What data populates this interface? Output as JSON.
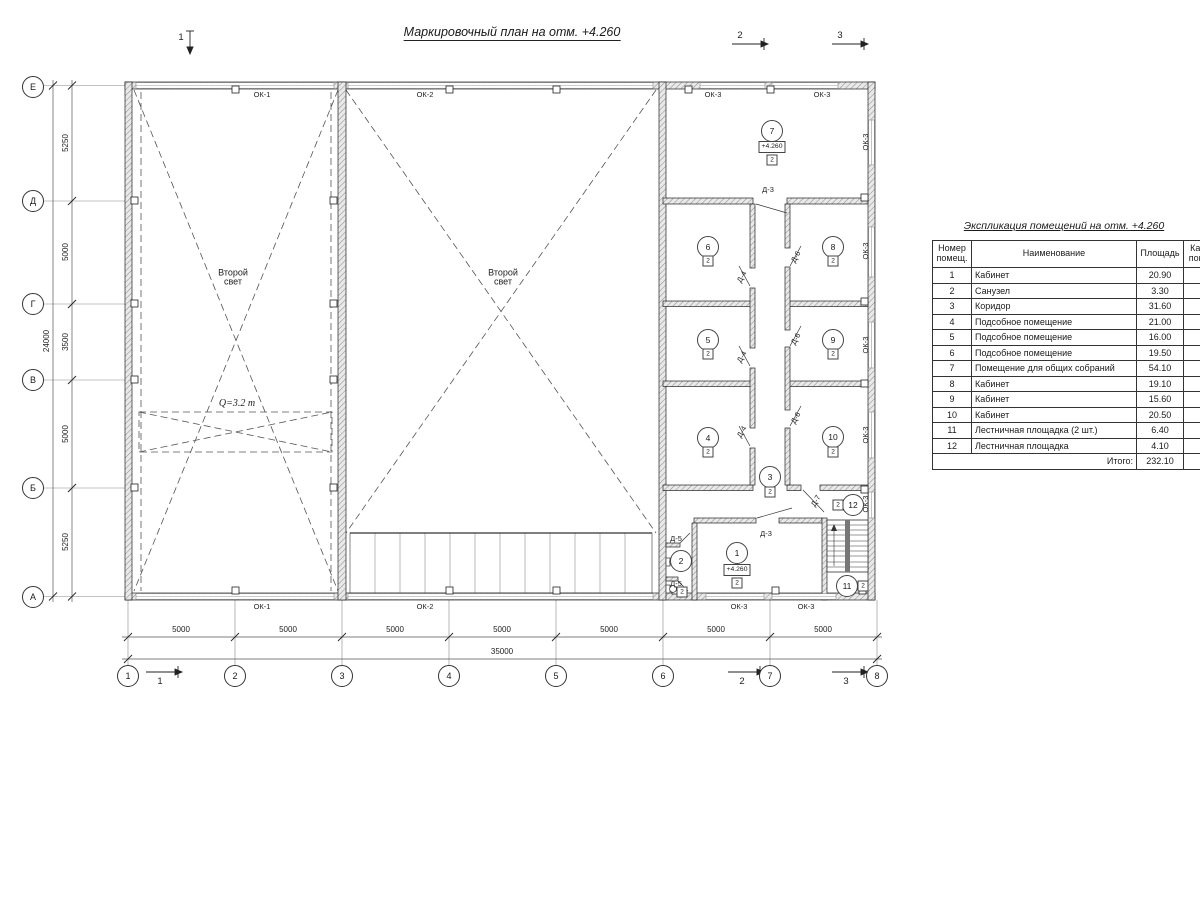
{
  "title": "Маркировочный план на отм. +4.260",
  "table": {
    "title": "Экспликация помещений на отм. +4.260",
    "col_num": "Номер\nпомещ.",
    "col_name": "Наименование",
    "col_area": "Площадь",
    "col_cat": "Кат.\nпом.",
    "rows": [
      {
        "num": "1",
        "name": "Кабинет",
        "area": "20.90",
        "cat": ""
      },
      {
        "num": "2",
        "name": "Санузел",
        "area": "3.30",
        "cat": ""
      },
      {
        "num": "3",
        "name": "Коридор",
        "area": "31.60",
        "cat": ""
      },
      {
        "num": "4",
        "name": "Подсобное помещение",
        "area": "21.00",
        "cat": ""
      },
      {
        "num": "5",
        "name": "Подсобное помещение",
        "area": "16.00",
        "cat": ""
      },
      {
        "num": "6",
        "name": "Подсобное помещение",
        "area": "19.50",
        "cat": ""
      },
      {
        "num": "7",
        "name": "Помещение для общих собраний",
        "area": "54.10",
        "cat": ""
      },
      {
        "num": "8",
        "name": "Кабинет",
        "area": "19.10",
        "cat": ""
      },
      {
        "num": "9",
        "name": "Кабинет",
        "area": "15.60",
        "cat": ""
      },
      {
        "num": "10",
        "name": "Кабинет",
        "area": "20.50",
        "cat": ""
      },
      {
        "num": "11",
        "name": "Лестничная площадка (2 шт.)",
        "area": "6.40",
        "cat": ""
      },
      {
        "num": "12",
        "name": "Лестничная площадка",
        "area": "4.10",
        "cat": ""
      }
    ],
    "total_label": "Итого:",
    "total_value": "232.10"
  },
  "plan": {
    "axes_bottom": [
      {
        "label": "1",
        "x": 128,
        "y": 676
      },
      {
        "label": "2",
        "x": 235,
        "y": 676
      },
      {
        "label": "3",
        "x": 342,
        "y": 676
      },
      {
        "label": "4",
        "x": 449,
        "y": 676
      },
      {
        "label": "5",
        "x": 556,
        "y": 676
      },
      {
        "label": "6",
        "x": 663,
        "y": 676
      },
      {
        "label": "7",
        "x": 770,
        "y": 676
      },
      {
        "label": "8",
        "x": 877,
        "y": 676
      }
    ],
    "axes_left": [
      {
        "label": "Е",
        "x": 33,
        "y": 87
      },
      {
        "label": "Д",
        "x": 33,
        "y": 201
      },
      {
        "label": "Г",
        "x": 33,
        "y": 304
      },
      {
        "label": "В",
        "x": 33,
        "y": 380
      },
      {
        "label": "Б",
        "x": 33,
        "y": 488
      },
      {
        "label": "А",
        "x": 33,
        "y": 597
      }
    ],
    "dims": [
      {
        "text": "5000",
        "x": 181,
        "y": 630
      },
      {
        "text": "5000",
        "x": 288,
        "y": 630
      },
      {
        "text": "5000",
        "x": 395,
        "y": 630
      },
      {
        "text": "5000",
        "x": 502,
        "y": 630
      },
      {
        "text": "5000",
        "x": 609,
        "y": 630
      },
      {
        "text": "5000",
        "x": 716,
        "y": 630
      },
      {
        "text": "5000",
        "x": 823,
        "y": 630
      },
      {
        "text": "35000",
        "x": 502,
        "y": 652
      },
      {
        "text": "5250",
        "x": 66,
        "y": 143,
        "rot": -90
      },
      {
        "text": "5000",
        "x": 66,
        "y": 252,
        "rot": -90
      },
      {
        "text": "3500",
        "x": 66,
        "y": 342,
        "rot": -90
      },
      {
        "text": "5000",
        "x": 66,
        "y": 434,
        "rot": -90
      },
      {
        "text": "5250",
        "x": 66,
        "y": 542,
        "rot": -90
      },
      {
        "text": "24000",
        "x": 47,
        "y": 341,
        "rot": -90
      }
    ],
    "sections": [
      {
        "label": "1",
        "x": 181,
        "y": 38
      },
      {
        "label": "2",
        "x": 740,
        "y": 36
      },
      {
        "label": "3",
        "x": 840,
        "y": 36
      },
      {
        "label": "1",
        "x": 160,
        "y": 682
      },
      {
        "label": "2",
        "x": 742,
        "y": 682
      },
      {
        "label": "3",
        "x": 846,
        "y": 682
      }
    ],
    "window_labels": [
      {
        "text": "ОК-1",
        "x": 262,
        "y": 95
      },
      {
        "text": "ОК-2",
        "x": 425,
        "y": 95
      },
      {
        "text": "ОК-3",
        "x": 713,
        "y": 95
      },
      {
        "text": "ОК-3",
        "x": 822,
        "y": 95
      },
      {
        "text": "ОК-1",
        "x": 262,
        "y": 607
      },
      {
        "text": "ОК-2",
        "x": 425,
        "y": 607
      },
      {
        "text": "ОК-3",
        "x": 739,
        "y": 607
      },
      {
        "text": "ОК-3",
        "x": 806,
        "y": 607
      },
      {
        "text": "ОК-3",
        "x": 866,
        "y": 142,
        "rot": -90
      },
      {
        "text": "ОК-3",
        "x": 866,
        "y": 251,
        "rot": -90
      },
      {
        "text": "ОК-3",
        "x": 866,
        "y": 345,
        "rot": -90
      },
      {
        "text": "ОК-3",
        "x": 866,
        "y": 435,
        "rot": -90
      },
      {
        "text": "ОК-3",
        "x": 866,
        "y": 504,
        "rot": -90
      }
    ],
    "door_labels": [
      {
        "text": "Д-3",
        "x": 768,
        "y": 190
      },
      {
        "text": "Д-3",
        "x": 766,
        "y": 534
      },
      {
        "text": "Д-4",
        "x": 742,
        "y": 277,
        "rot": -60
      },
      {
        "text": "Д-4",
        "x": 742,
        "y": 357,
        "rot": -60
      },
      {
        "text": "Д-4",
        "x": 742,
        "y": 432,
        "rot": -60
      },
      {
        "text": "Д-6",
        "x": 796,
        "y": 257,
        "rot": -60
      },
      {
        "text": "Д-6",
        "x": 796,
        "y": 339,
        "rot": -60
      },
      {
        "text": "Д-6",
        "x": 796,
        "y": 418,
        "rot": -60
      },
      {
        "text": "Д-5",
        "x": 676,
        "y": 539
      },
      {
        "text": "Д-5",
        "x": 676,
        "y": 584
      },
      {
        "text": "Д-7",
        "x": 816,
        "y": 501,
        "rot": -60
      }
    ],
    "room_circles": [
      {
        "num": "1",
        "x": 737,
        "y": 553
      },
      {
        "num": "2",
        "x": 681,
        "y": 561
      },
      {
        "num": "3",
        "x": 770,
        "y": 477
      },
      {
        "num": "4",
        "x": 708,
        "y": 438
      },
      {
        "num": "5",
        "x": 708,
        "y": 340
      },
      {
        "num": "6",
        "x": 708,
        "y": 247
      },
      {
        "num": "7",
        "x": 772,
        "y": 131
      },
      {
        "num": "8",
        "x": 833,
        "y": 247
      },
      {
        "num": "9",
        "x": 833,
        "y": 340
      },
      {
        "num": "10",
        "x": 833,
        "y": 437
      },
      {
        "num": "11",
        "x": 847,
        "y": 586
      },
      {
        "num": "12",
        "x": 853,
        "y": 505
      }
    ],
    "cat_marks": [
      {
        "text": "2",
        "x": 737,
        "y": 583
      },
      {
        "text": "2",
        "x": 682,
        "y": 592
      },
      {
        "text": "2",
        "x": 770,
        "y": 492
      },
      {
        "text": "2",
        "x": 708,
        "y": 452
      },
      {
        "text": "2",
        "x": 708,
        "y": 354
      },
      {
        "text": "2",
        "x": 708,
        "y": 261
      },
      {
        "text": "2",
        "x": 772,
        "y": 160
      },
      {
        "text": "2",
        "x": 833,
        "y": 261
      },
      {
        "text": "2",
        "x": 833,
        "y": 354
      },
      {
        "text": "2",
        "x": 833,
        "y": 452
      },
      {
        "text": "2",
        "x": 863,
        "y": 586
      },
      {
        "text": "2",
        "x": 838,
        "y": 505
      }
    ],
    "elev_marks": [
      {
        "text": "+4.260",
        "x": 772,
        "y": 147
      },
      {
        "text": "+4.260",
        "x": 737,
        "y": 570
      }
    ],
    "hall_labels": [
      {
        "text": "Второй\nсвет",
        "x": 233,
        "y": 278
      },
      {
        "text": "Второй\nсвет",
        "x": 503,
        "y": 278
      }
    ],
    "crane_labels": [
      {
        "text": "Q=3.2 т",
        "x": 237,
        "y": 404
      }
    ]
  }
}
